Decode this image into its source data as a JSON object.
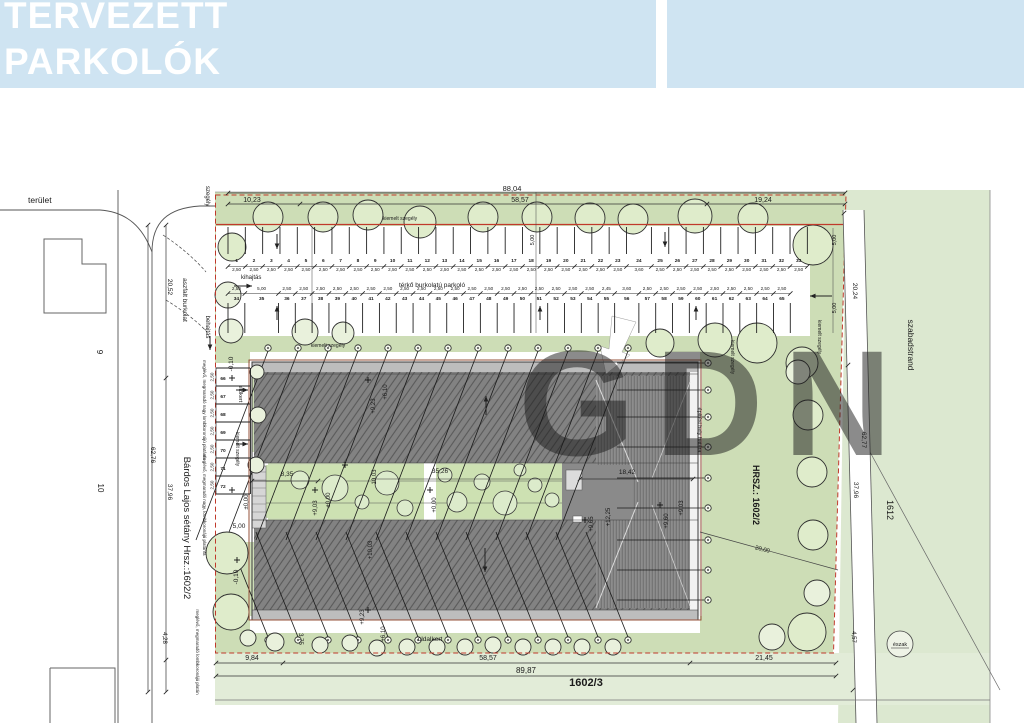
{
  "header": {
    "line1": "TERVEZETT",
    "line2": "PARKOLÓK"
  },
  "watermark": "GDN",
  "colors": {
    "header_bg": "#cfe4f2",
    "green_main": "#cdddb6",
    "green_light": "#dce8d0",
    "green_band": "#e2ecd8",
    "green_court": "#cde1b2",
    "roof_gray": "#828282",
    "boundary_red": "#c0392b",
    "boundary_brown": "#96503a"
  },
  "parking": {
    "row1": {
      "numbers": [
        "1",
        "2",
        "3",
        "4",
        "5",
        "6",
        "7",
        "8",
        "9",
        "10",
        "11",
        "12",
        "13",
        "14",
        "15",
        "16",
        "17",
        "18",
        "19",
        "20",
        "21",
        "22",
        "23",
        "24",
        "25",
        "26",
        "27",
        "28",
        "29",
        "30",
        "31",
        "32",
        "33"
      ],
      "dims": [
        "2,50",
        "2,50",
        "2,50",
        "2,50",
        "2,50",
        "2,50",
        "2,50",
        "2,50",
        "2,50",
        "2,50",
        "2,50",
        "2,50",
        "2,50",
        "2,50",
        "2,50",
        "2,50",
        "2,50",
        "2,50",
        "2,50",
        "2,50",
        "2,50",
        "2,50",
        "2,50",
        "3,60",
        "2,50",
        "2,50",
        "2,50",
        "2,50",
        "2,50",
        "2,50",
        "2,50",
        "2,50",
        "2,50"
      ]
    },
    "row2": {
      "numbers": [
        "34",
        "35",
        "36",
        "37",
        "38",
        "39",
        "40",
        "41",
        "42",
        "43",
        "44",
        "45",
        "46",
        "47",
        "48",
        "49",
        "50",
        "51",
        "52",
        "53",
        "54",
        "55",
        "56",
        "57",
        "58",
        "59",
        "60",
        "61",
        "62",
        "63",
        "64",
        "65"
      ],
      "dims": [
        "2,50",
        "5,00",
        "2,50",
        "2,50",
        "2,50",
        "2,50",
        "2,50",
        "2,50",
        "2,50",
        "2,50",
        "2,50",
        "2,50",
        "2,50",
        "2,50",
        "2,50",
        "2,50",
        "2,50",
        "2,50",
        "2,50",
        "2,50",
        "2,50",
        "2,45",
        "3,60",
        "2,50",
        "2,50",
        "2,50",
        "2,50",
        "2,50",
        "2,50",
        "2,50",
        "2,50",
        "2,50"
      ]
    },
    "row3": {
      "numbers": [
        "66",
        "67",
        "68",
        "69",
        "70",
        "71",
        "72"
      ],
      "dims": [
        "2,50",
        "2,50",
        "2,50",
        "2,50",
        "2,50",
        "2,50",
        "2,50"
      ]
    }
  },
  "labels": {
    "terulet": "terület",
    "haz9": "9",
    "haz10": "10",
    "aszfalt": "aszfalt burkolat",
    "bardos": "Bárdos Lajos sétány Hrsz.:1602/2",
    "szegely_top": "szegély",
    "dim_2052": "20,52",
    "dim_6276": "62,76",
    "dim_3796l": "37,96",
    "dim_428": "4,28",
    "dim_8804": "88,04",
    "dim_1023": "10,23",
    "dim_5857t": "58,57",
    "dim_1924": "19,24",
    "kiemelt_top": "kiemelt szegély",
    "kiemelt_mid": "kiemelt szegély",
    "kiemelt_r1": "kiemelt szegély",
    "kiemelt_r2": "kiemelt szegély",
    "kiemelt_left": "kiemelt szegély",
    "kihajtas": "kihajtás",
    "behajtas": "behajtás",
    "terko": "térkő burkolatú parkoló",
    "d500a": "5,00",
    "d500b": "5,00",
    "d500c": "5,00",
    "d500entry": "5,00",
    "m010a": "-0,10",
    "m010b": "-0,10",
    "pm000a": "±0,00",
    "pm000b": "±0,00",
    "p000": "+0,00",
    "p903a": "+9,03",
    "p903b": "+9,03",
    "p610a": "+6,10",
    "p610b": "+6,10",
    "p923a": "+9,23",
    "p923b": "+9,23",
    "p1003": "+10,03",
    "d1003": "10,03",
    "d3526": "35,26",
    "d835": "8,35",
    "d1842": "18,42",
    "p1225": "+12,25",
    "p965": "+9,65",
    "p960": "+9,60",
    "epitesi": "építési hely határa",
    "hrsz": "HRSZ.: 1602/2",
    "szabadstrand": "szabadstrand",
    "d2024": "20,24",
    "d6277": "62,77",
    "d3796r": "37,96",
    "d457": "4,57",
    "lot1612": "1612",
    "d2000": "20,00",
    "elokert": "előkert",
    "oldalkert": "oldalkert",
    "d984": "9,84",
    "d5857b": "58,57",
    "d2145": "21,45",
    "d8987": "89,87",
    "lot16023": "1602/3",
    "d375": "3,75",
    "meglevo1": "meglévő, megmaradó nagy lombkoronájú platánfa",
    "meglevo2": "meglévő, megmaradó nagy, lombkoronájú platánfa",
    "meglevo3": "meglévő, megmaradó lombkoronájú platán",
    "eszak": "észak"
  }
}
